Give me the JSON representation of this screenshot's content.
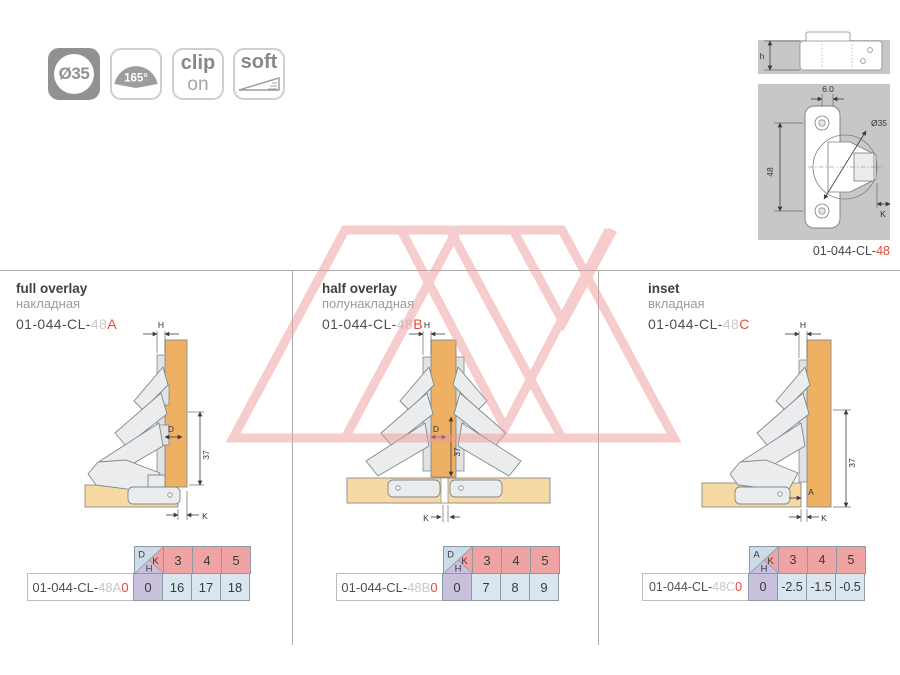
{
  "page": {
    "width": 900,
    "height": 675,
    "background": "#ffffff"
  },
  "colors": {
    "accent_red": "#e8473e",
    "muted_gray": "#c8c8c8",
    "ink": "#4f4f4f",
    "table_pink": "#f0a3a3",
    "table_blue": "#d9e6ef",
    "table_purple": "#c9c0dd",
    "table_border": "#8d99a6",
    "wood_door": "#eeb164",
    "wood_cabinet": "#f6d9a3",
    "hinge_gray": "#eaecee",
    "panel_gray": "#c7c7c8",
    "watermark_pink": "#ef9a9a"
  },
  "feature_icons": [
    {
      "name": "cup-diameter",
      "label": "Ø35"
    },
    {
      "name": "opening-angle",
      "label": "165°"
    },
    {
      "name": "clip-on",
      "line1": "clip",
      "line2": "on"
    },
    {
      "name": "soft-close",
      "label": "soft"
    }
  ],
  "top_drawing": {
    "part_prefix": "01-044-CL-",
    "part_suffix": "48",
    "dim_h": "h",
    "dim_hole": "6.0",
    "dim_height": "48",
    "dim_cup": "Ø35",
    "dim_k": "K"
  },
  "sections": [
    {
      "title": "full overlay",
      "title_ru": "накладная",
      "pn_prefix": "01-044-CL-",
      "pn_mid": "48",
      "pn_letter": "A",
      "dim_top": "H",
      "dim_d": "D",
      "dim_v": "37",
      "dim_k": "K",
      "table": {
        "corner_top": "D",
        "corner_right": "K",
        "corner_bottom": "H",
        "cols": [
          "3",
          "4",
          "5"
        ],
        "part_prefix": "01-044-CL-",
        "part_mid": "48A",
        "part_tail": "0",
        "h_value": "0",
        "values": [
          "16",
          "17",
          "18"
        ]
      }
    },
    {
      "title": "half overlay",
      "title_ru": "полунакладная",
      "pn_prefix": "01-044-CL-",
      "pn_mid": "48",
      "pn_letter": "B",
      "dim_top": "H",
      "dim_d": "D",
      "dim_v": "37",
      "dim_k": "K",
      "table": {
        "corner_top": "D",
        "corner_right": "K",
        "corner_bottom": "H",
        "cols": [
          "3",
          "4",
          "5"
        ],
        "part_prefix": "01-044-CL-",
        "part_mid": "48B",
        "part_tail": "0",
        "h_value": "0",
        "values": [
          "7",
          "8",
          "9"
        ]
      }
    },
    {
      "title": "inset",
      "title_ru": "вкладная",
      "pn_prefix": "01-044-CL-",
      "pn_mid": "48",
      "pn_letter": "C",
      "dim_top": "H",
      "dim_a": "A",
      "dim_v": "37",
      "dim_k": "K",
      "table": {
        "corner_top": "A",
        "corner_right": "K",
        "corner_bottom": "H",
        "cols": [
          "3",
          "4",
          "5"
        ],
        "part_prefix": "01-044-CL-",
        "part_mid": "48C",
        "part_tail": "0",
        "h_value": "0",
        "values": [
          "-2.5",
          "-1.5",
          "-0.5"
        ]
      }
    }
  ]
}
